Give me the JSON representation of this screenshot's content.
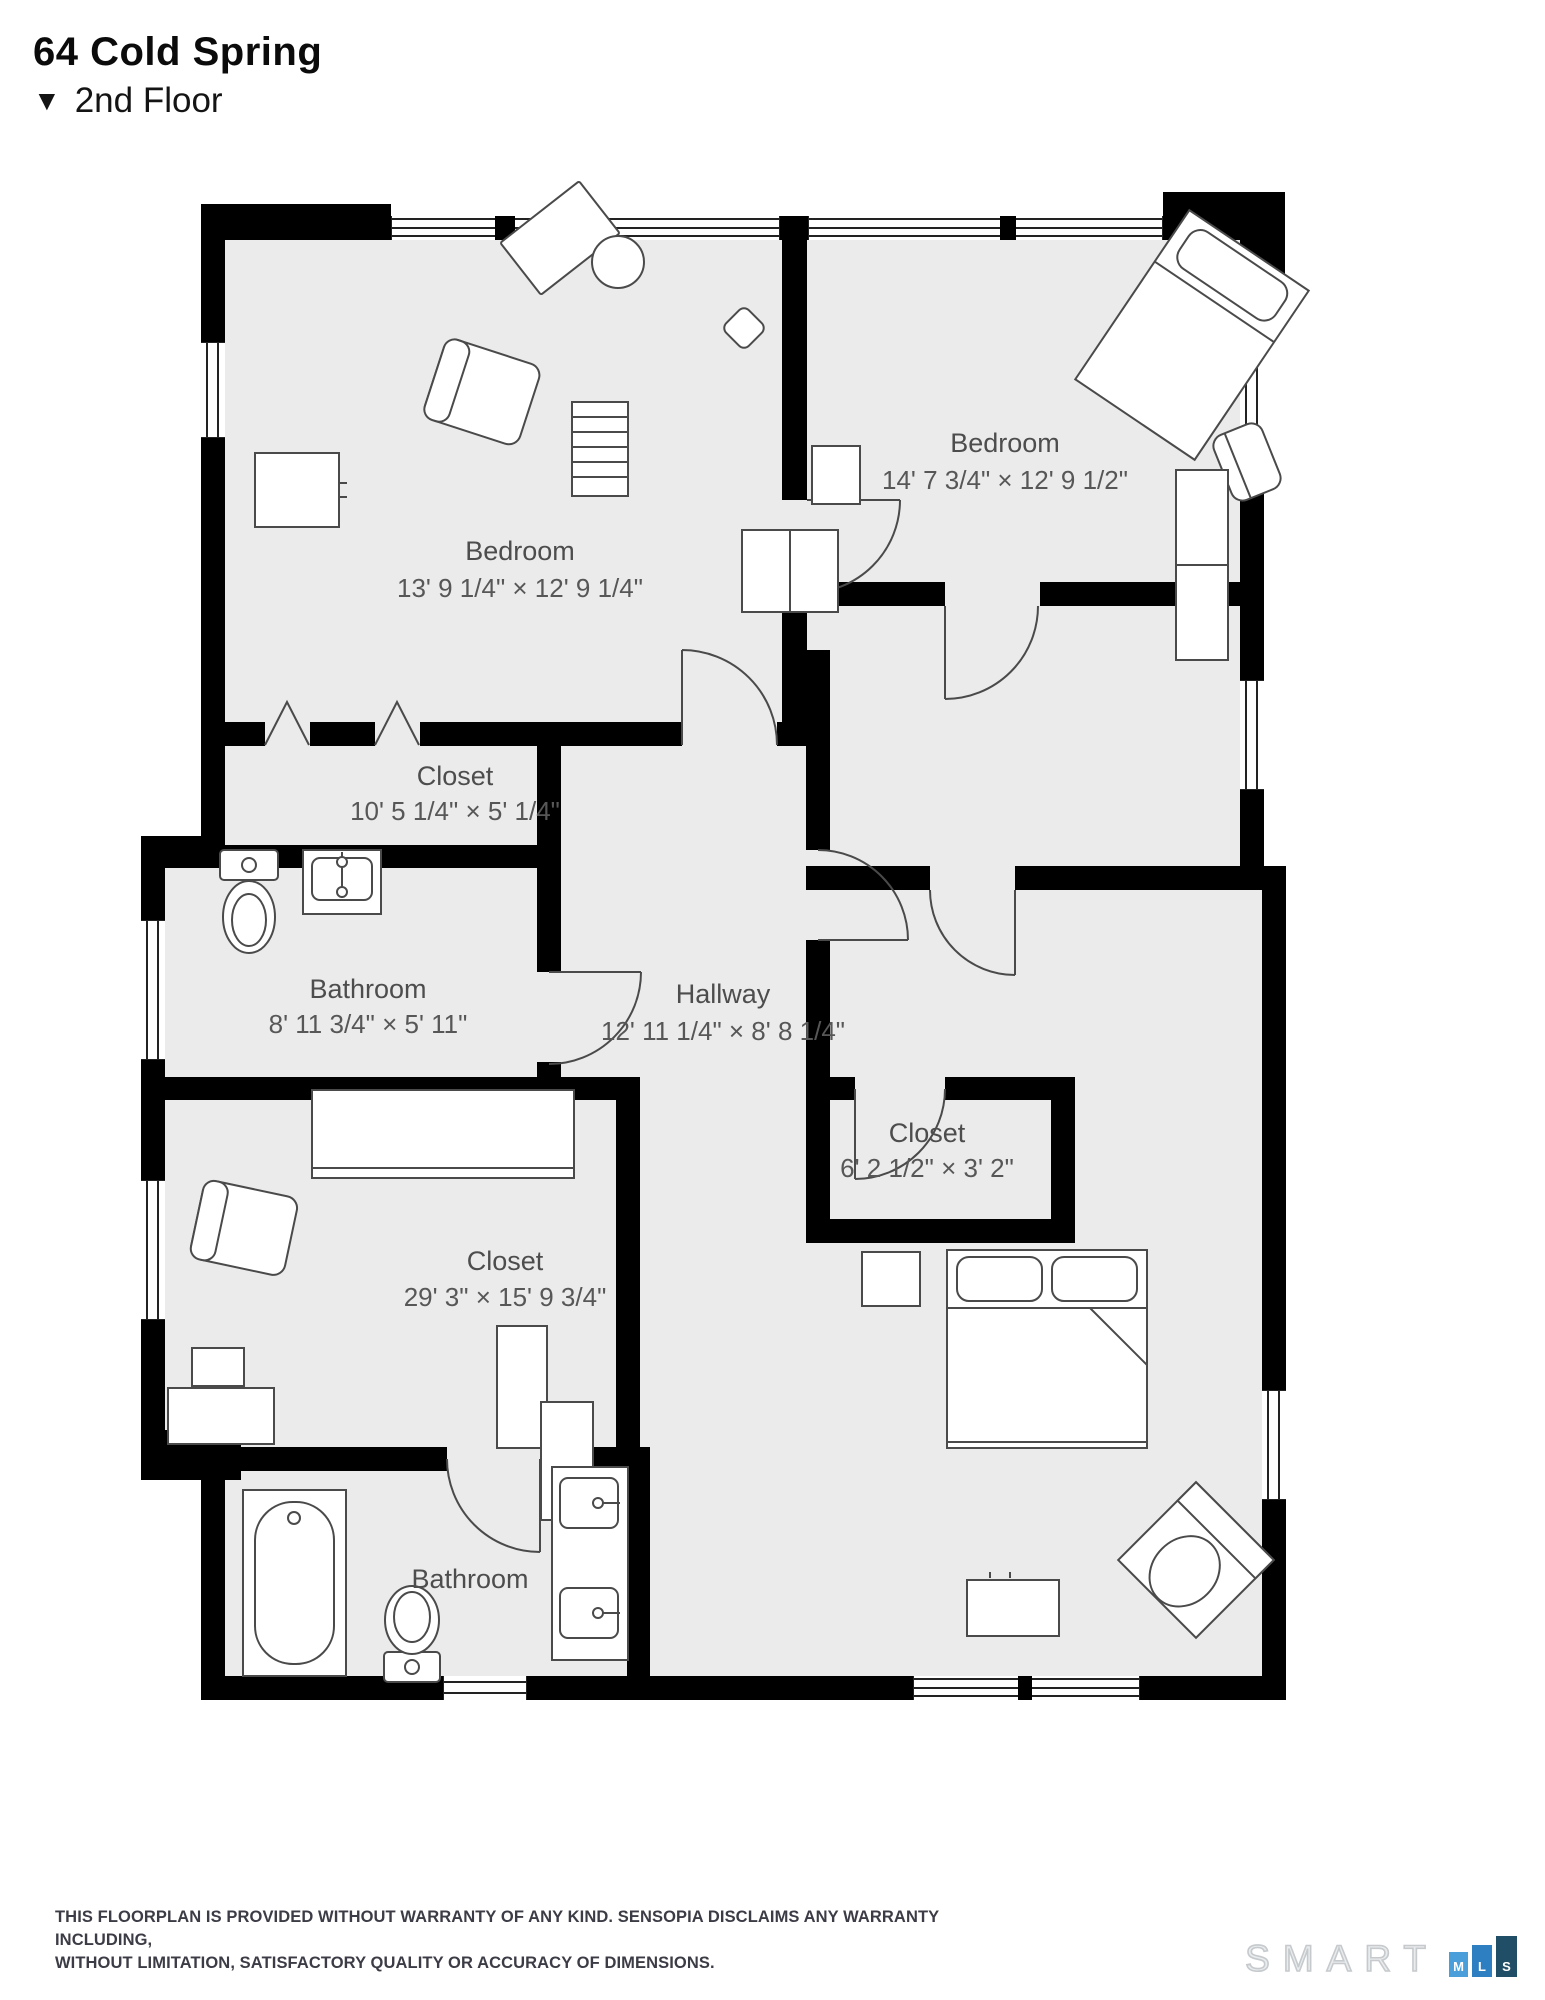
{
  "header": {
    "title": "64 Cold Spring",
    "floor_icon": "▼",
    "floor_label": "2nd Floor"
  },
  "rooms": [
    {
      "name": "Bedroom",
      "dims": "13' 9 1/4\" × 12' 9 1/4\""
    },
    {
      "name": "Bedroom",
      "dims": "14' 7 3/4\" × 12' 9 1/2\""
    },
    {
      "name": "Closet",
      "dims": "10' 5 1/4\" × 5' 1/4\""
    },
    {
      "name": "Bathroom",
      "dims": "8' 11 3/4\" × 5' 11\""
    },
    {
      "name": "Hallway",
      "dims": "12' 11 1/4\" × 8' 8 1/4\""
    },
    {
      "name": "Closet",
      "dims": "6' 2 1/2\" × 3' 2\""
    },
    {
      "name": "Closet",
      "dims": "29' 3\" × 15' 9 3/4\""
    },
    {
      "name": "Bathroom",
      "dims": ""
    }
  ],
  "footer": {
    "line1": "THIS FLOORPLAN IS PROVIDED WITHOUT WARRANTY OF ANY KIND. SENSOPIA DISCLAIMS ANY WARRANTY INCLUDING,",
    "line2": "WITHOUT LIMITATION, SATISFACTORY QUALITY OR ACCURACY OF DIMENSIONS."
  },
  "logo": {
    "word": "SMART",
    "boxes": [
      {
        "letter": "M",
        "color": "#4a9ed9"
      },
      {
        "letter": "L",
        "color": "#2e7fc2"
      },
      {
        "letter": "S",
        "color": "#204e66"
      }
    ]
  },
  "colors": {
    "floor": "#ebebeb",
    "wall": "#000000",
    "label": "#4d4d4d",
    "furniture_stroke": "#4a4a4a"
  }
}
